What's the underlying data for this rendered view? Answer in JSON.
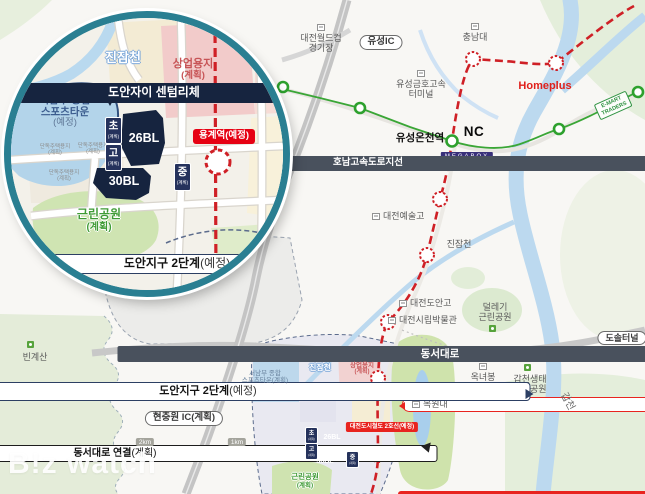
{
  "colors": {
    "line1_green": "#3aa636",
    "line2_red": "#cf2026",
    "navy_block": "#16243f",
    "station_red": "#e60113",
    "inset_ring": "#2a7f92"
  },
  "watermark": "B!z watch",
  "inset": {
    "stream_label": "진잠천",
    "commercial_line1": "상업용지",
    "commercial_line2": "(계획)",
    "sports_line1": "서남부 종합",
    "sports_line2": "스포츠타운",
    "sports_line3": "(예정)",
    "callout": "도안자이 센텀리체",
    "block_26": "26BL",
    "block_30": "30BL",
    "school_elem_char": "초",
    "school_high_char": "고",
    "school_mid_char": "중",
    "school_sub": "(계획)",
    "housing_line1": "단독주택용지",
    "housing_line2": "(계획)",
    "park_line1": "근린공원",
    "park_line2": "(계획)",
    "station_label": "용계역(예정)",
    "district_bold": "도안지구 2단계",
    "district_normal": "(예정)"
  },
  "main": {
    "worldcup_line1": "대전월드컵",
    "worldcup_line2": "경기장",
    "yuseong_ic": "유성IC",
    "chungnam": "충남대",
    "terminal_line1": "유성금호고속",
    "terminal_line2": "터미널",
    "homeplus": "Homeplus",
    "emart_line1": "E-MART",
    "emart_line2": "TRADERS",
    "nc": "NC",
    "yuseong_oncheon": "유성온천역",
    "megabox": "MEGABOX",
    "honam_expressway": "호남고속도로지선",
    "arts_high": "대전예술고",
    "jinjamcheon_upper": "진잠천",
    "doan_high": "대전도안고",
    "museum": "대전시립박물관",
    "dallegi_line1": "덜레기",
    "dallegi_line2": "근린공원",
    "dongseo_daero": "동서대로",
    "dosol_tunnel": "도솔터널",
    "doan_station_bold": "도안역",
    "doan_station_normal": "(예정)",
    "oknyeobong_line1": "옥녀봉",
    "oknyeobong_line2": "체육공원",
    "gapcheon_eco_line1": "갑천생태",
    "gapcheon_eco_line2": "호수공원",
    "gapcheon": "갑천",
    "mokwon": "목원대",
    "line2_badge": "대전도시철도 2호선(예정)",
    "yonggye_station": "용계역(예정)",
    "district2_bold": "도안지구 2단계",
    "district2_normal": "(예정)",
    "district3_line1": "도안지구 3단계",
    "district3_line2": "(계획)",
    "sports_line1": "서남부 종합",
    "sports_line2": "스포츠타운(계획)",
    "dongseo_connect_bold": "동서대로 연결",
    "dongseo_connect_normal": "(계획)",
    "bingyesan": "빈계산",
    "hyeonchungwon_ic": "현충원 IC(계획)",
    "scale_2km": "2km",
    "scale_1km": "1km",
    "callout": "도안자이 센텀리체",
    "block_26": "26BL",
    "block_30": "30BL",
    "school_elem": "초",
    "school_high": "고",
    "school_mid": "중",
    "school_sub": "(계획)",
    "jinjamcheon_lower": "진잠천",
    "commercial_line1": "상업용지",
    "commercial_line2": "(계획)",
    "park_line1": "근린공원",
    "park_line2": "(계획)"
  }
}
